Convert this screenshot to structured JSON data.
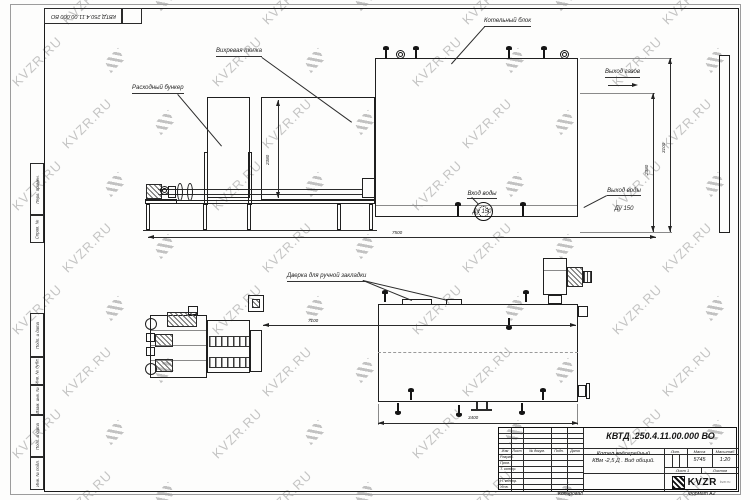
{
  "watermark": {
    "text": "KVZR.RU"
  },
  "stamp": {
    "top_left_designation": "КВТД 250.4.11.00.000  ВО"
  },
  "margin_labels": [
    "Перв. примен.",
    "Справ. №",
    "Подп. и дата",
    "Инв. № дубл.",
    "Взам. инв. №",
    "Подп. и дата",
    "Инв. № подл."
  ],
  "callouts": {
    "vortex_furnace": "Вихревая топка",
    "feed_hopper": "Расходный бункер",
    "boiler_unit": "Котельный блок",
    "manual_door": "Дверка для ручной закладки",
    "water_in_1": "Вход воды",
    "water_in_2": "Ду 150",
    "water_out_1": "Выход воды",
    "water_out_2": "Ду 150",
    "gas_out": "Выход газов"
  },
  "dims": {
    "furnace_height": "2380",
    "boiler_height": "2380",
    "total_height": "3100",
    "side_length": "7500",
    "plan_top_length": "7100",
    "plan_width": "3400"
  },
  "title_block": {
    "designation": "КВТД .250.4.11.00.000  ВО",
    "product_1": "Котел водогрейный",
    "product_2": "КВм -2,5 Д . Вид общий.",
    "col_lit": "Лит.",
    "col_mass": "Масса",
    "col_scale": "Масштаб",
    "mass_value": "5745",
    "scale_value": "1:20",
    "sheet": "Лист 1",
    "sheets": "Листов",
    "change_cols": [
      "Изм",
      "Лист",
      "№ докум.",
      "Подп.",
      "Дата"
    ],
    "rows": [
      "Разраб.",
      "Пров.",
      "Т. контр.",
      "",
      "Н. контр.",
      "Утв."
    ],
    "copied": "Копировал",
    "format": "Формат А2",
    "logo": "KVZR",
    "logo_sub": "kvzr.ru"
  }
}
